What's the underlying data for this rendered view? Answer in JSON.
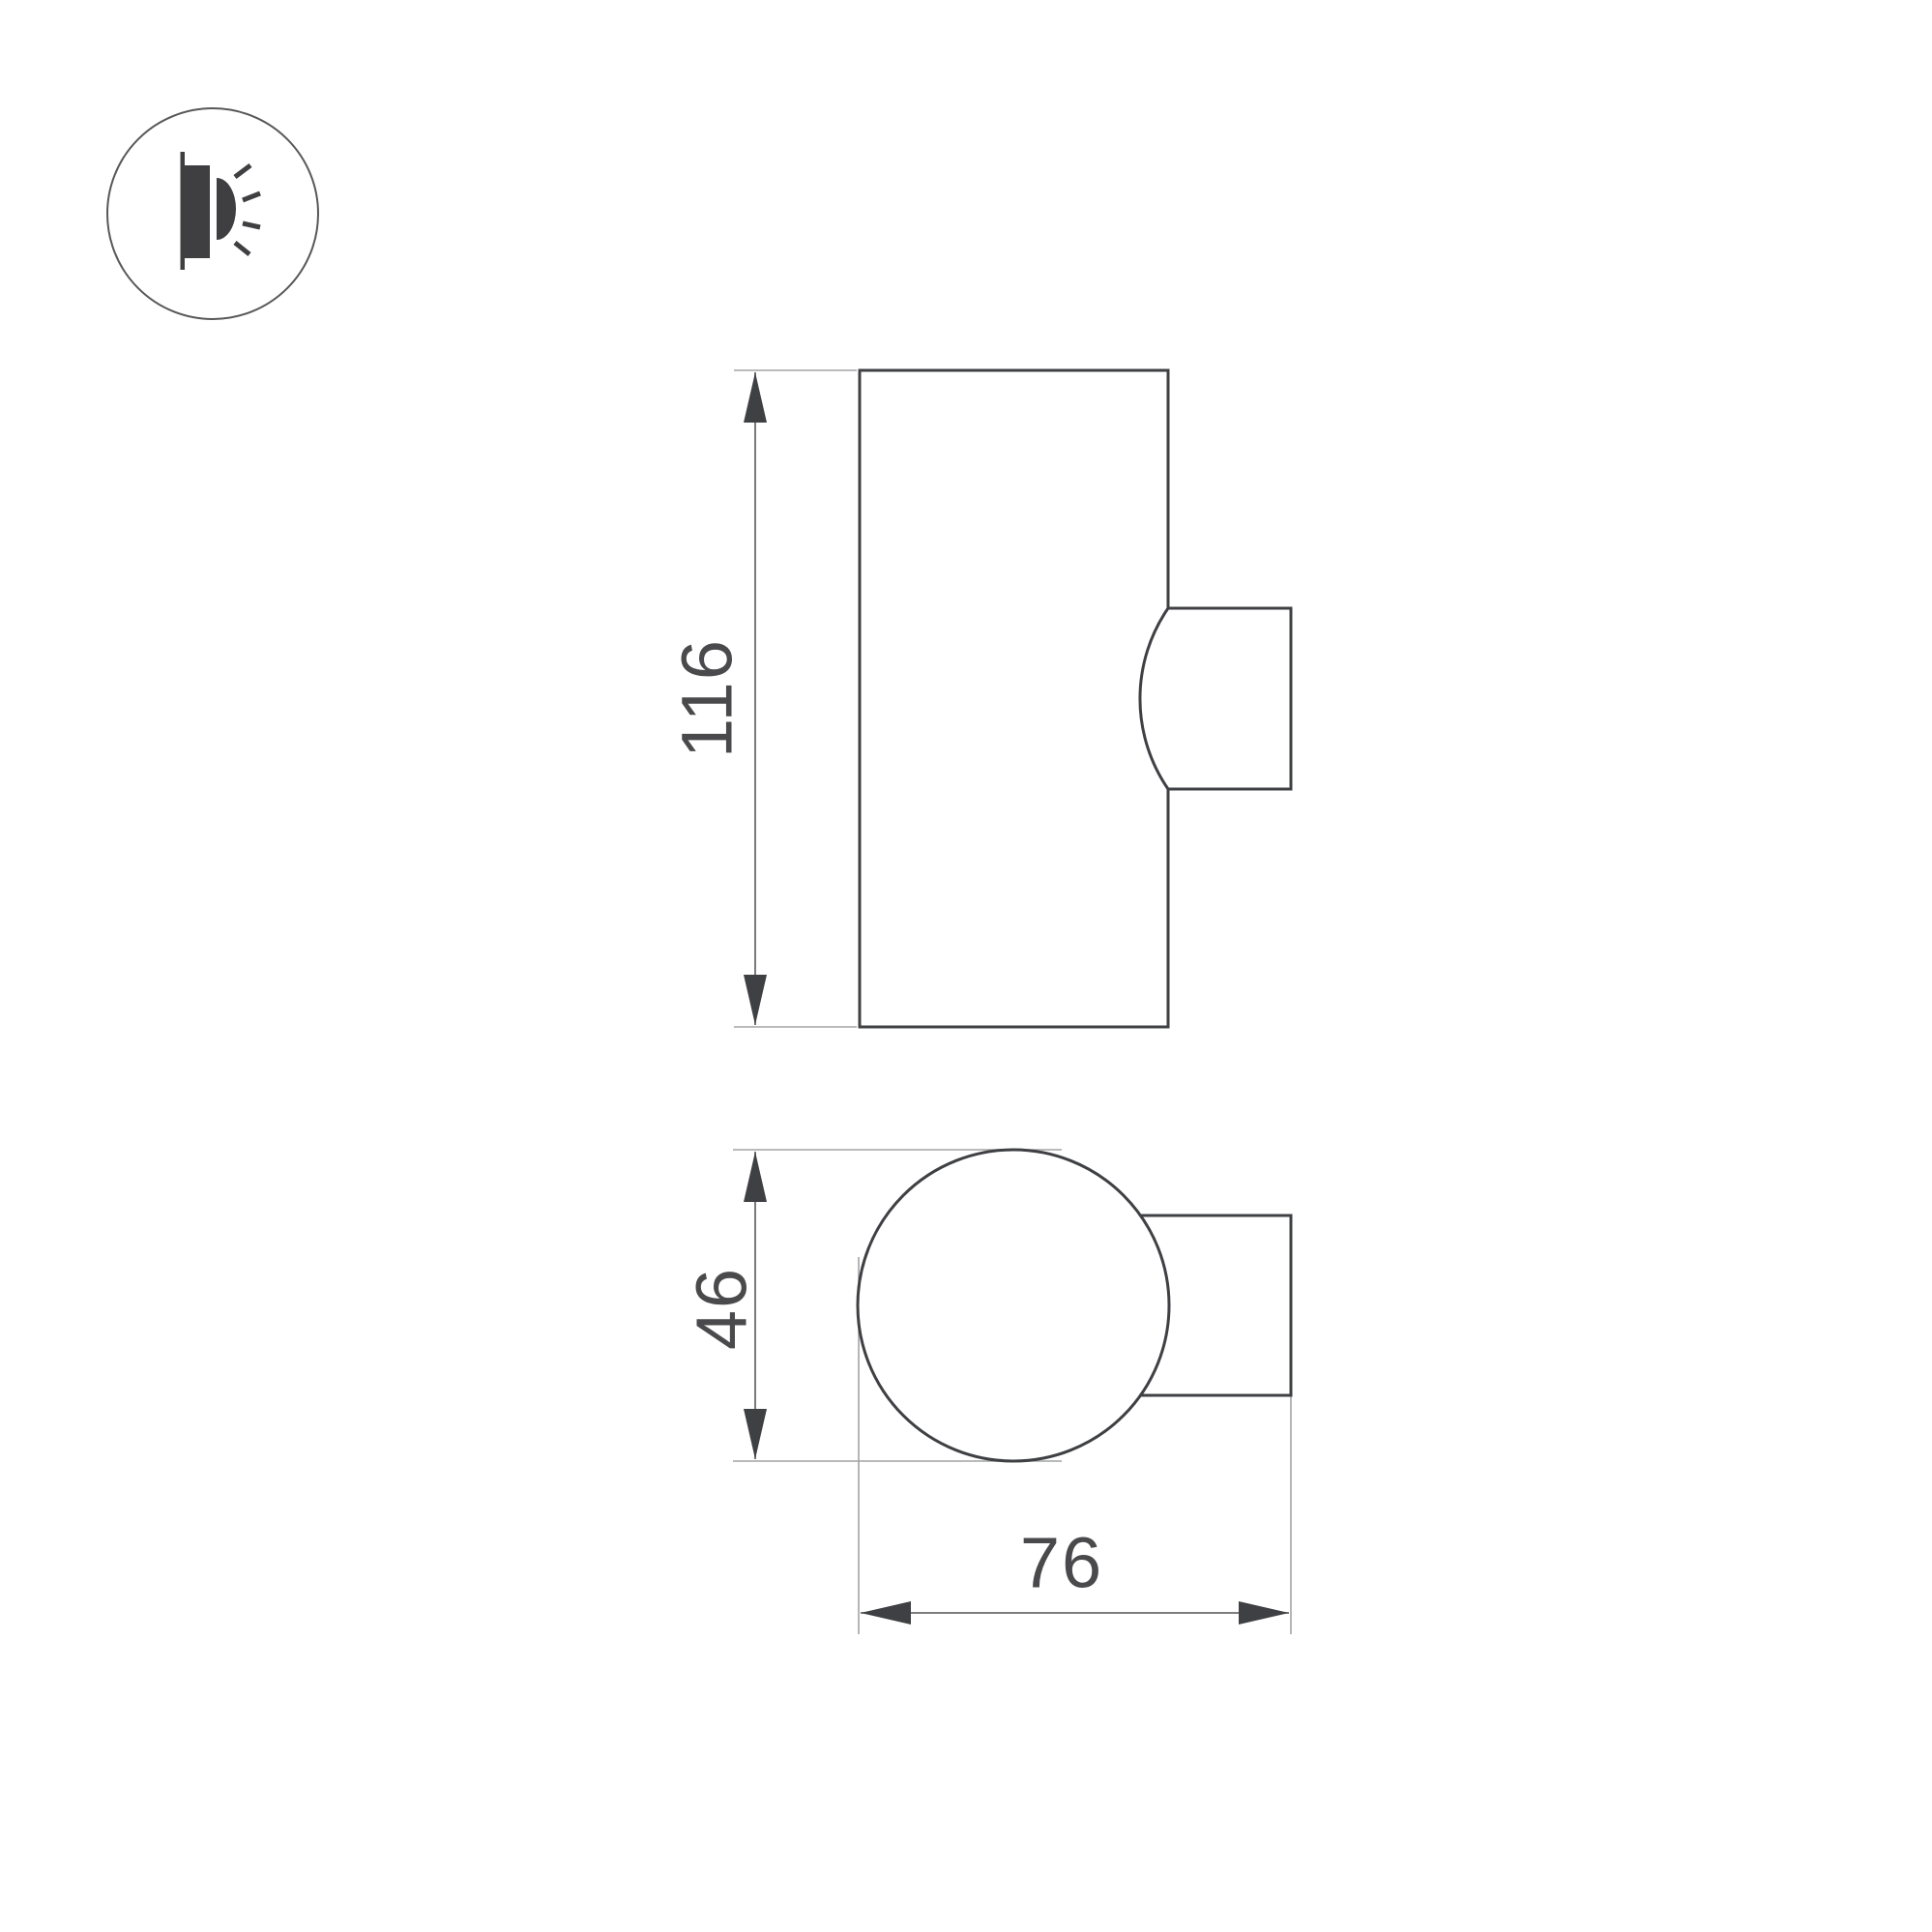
{
  "diagram": {
    "type": "technical-dimension-drawing",
    "subject": "cylindrical wall-mounted luminaire",
    "badge_icon": "wall-light-side-glow-icon",
    "views": [
      {
        "id": "side-view",
        "description": "side elevation of cylinder body with wall-mount bracket"
      },
      {
        "id": "top-view",
        "description": "plan view: circular body with wall-mount bracket"
      }
    ],
    "dimensions": {
      "height": {
        "value": "116",
        "orientation": "vertical",
        "view": "side-view"
      },
      "diameter": {
        "value": "46",
        "orientation": "vertical",
        "view": "top-view"
      },
      "depth": {
        "value": "76",
        "orientation": "horizontal",
        "view": "top-view"
      }
    },
    "colors": {
      "background": "#ffffff",
      "outline": "#3f4043",
      "extension_line": "#a3a3a3",
      "dimension_line": "#6b6b6d",
      "label_text": "#4a4a4c",
      "icon_fill": "#3f3f42"
    }
  }
}
